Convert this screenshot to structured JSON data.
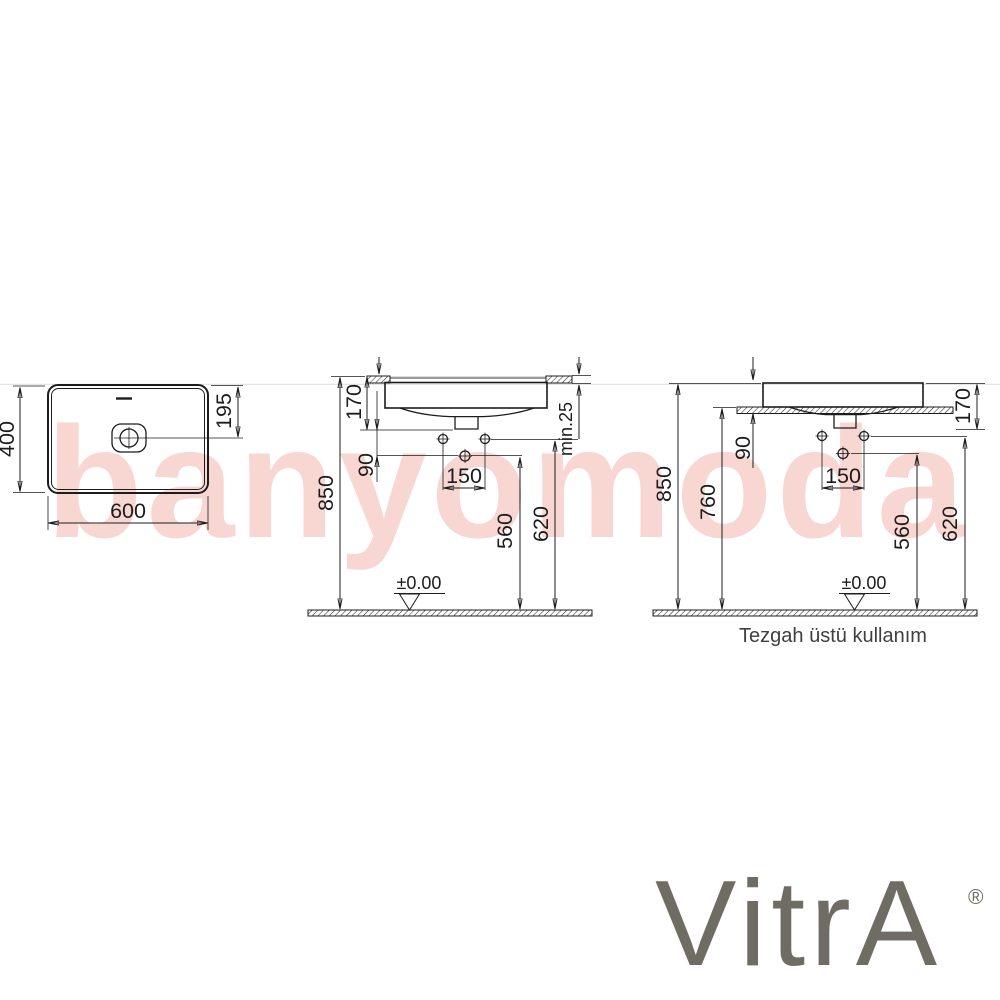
{
  "colors": {
    "line": "#1c1c1c",
    "watermark_pink": "#f8d6d2",
    "logo_gray": "#6f6d63",
    "counter_edge_gray": "#9b9b9b"
  },
  "watermark": {
    "text": "banyomoda"
  },
  "logo": {
    "text": "VitrA",
    "registered": "®"
  },
  "top_view": {
    "width": "600",
    "depth": "400",
    "drain_offset": "195"
  },
  "semi_recessed_view": {
    "basin_height": "170",
    "counter_thickness_min": "min.25",
    "basin_to_hole": "90",
    "hole_spacing": "150",
    "lower_hole_height": "560",
    "upper_hole_height": "620",
    "rim_height": "850",
    "floor_datum": "±0.00"
  },
  "countertop_view": {
    "basin_height": "170",
    "rim_to_counter": "90",
    "hole_spacing": "150",
    "lower_hole_height": "560",
    "upper_hole_height": "620",
    "counter_height": "760",
    "rim_height": "850",
    "floor_datum": "±0.00",
    "caption": "Tezgah üstü kullanım"
  }
}
